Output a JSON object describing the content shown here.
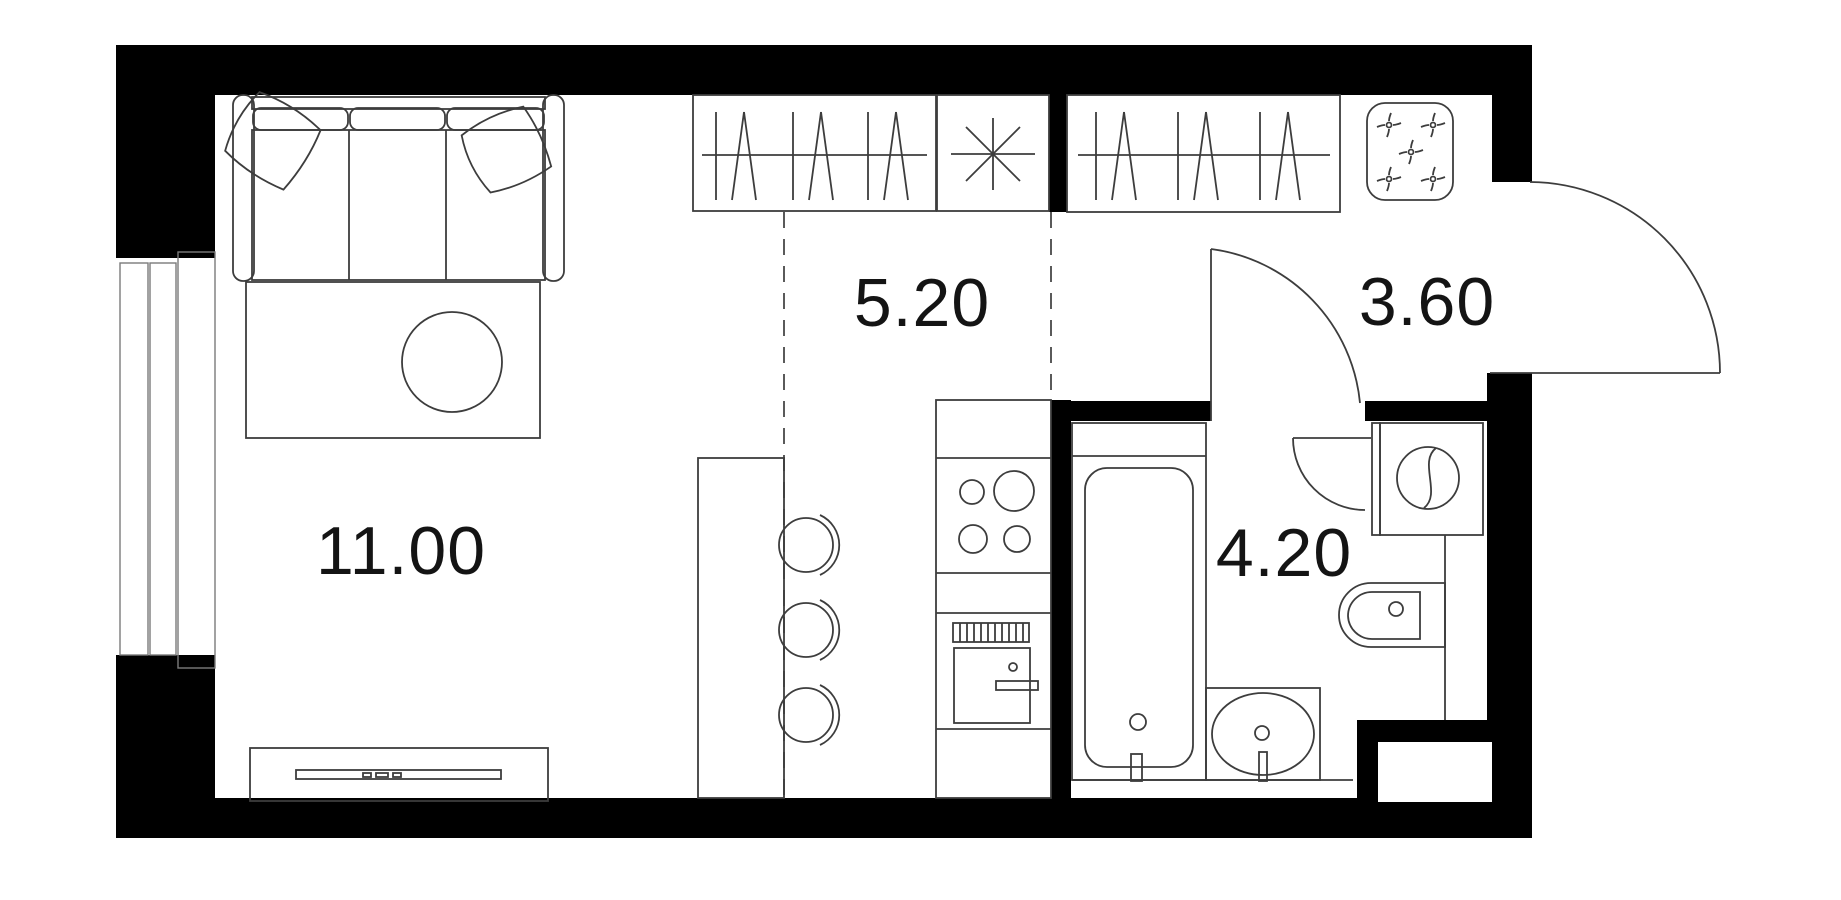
{
  "plan": {
    "type": "studio-apartment-floor-plan",
    "rooms": [
      {
        "id": "living-room",
        "area_label": "11.00"
      },
      {
        "id": "kitchen-zone",
        "area_label": "5.20"
      },
      {
        "id": "hallway",
        "area_label": "3.60"
      },
      {
        "id": "bathroom",
        "area_label": "4.20"
      }
    ],
    "fixtures": [
      "sofa",
      "pillows",
      "rug",
      "coffee-table",
      "tv-console",
      "wardrobe-with-hangers",
      "light-asterisk",
      "fan-appliance",
      "bar-counter",
      "bar-stools",
      "kitchen-counter",
      "hob-4-burners",
      "oven",
      "bathtub",
      "washbasin",
      "toilet",
      "washing-machine",
      "entrance-door",
      "bathroom-door",
      "window"
    ],
    "colors": {
      "wall": "#000000",
      "line": "#3d3d3d",
      "background": "#ffffff",
      "label": "#141414"
    }
  }
}
